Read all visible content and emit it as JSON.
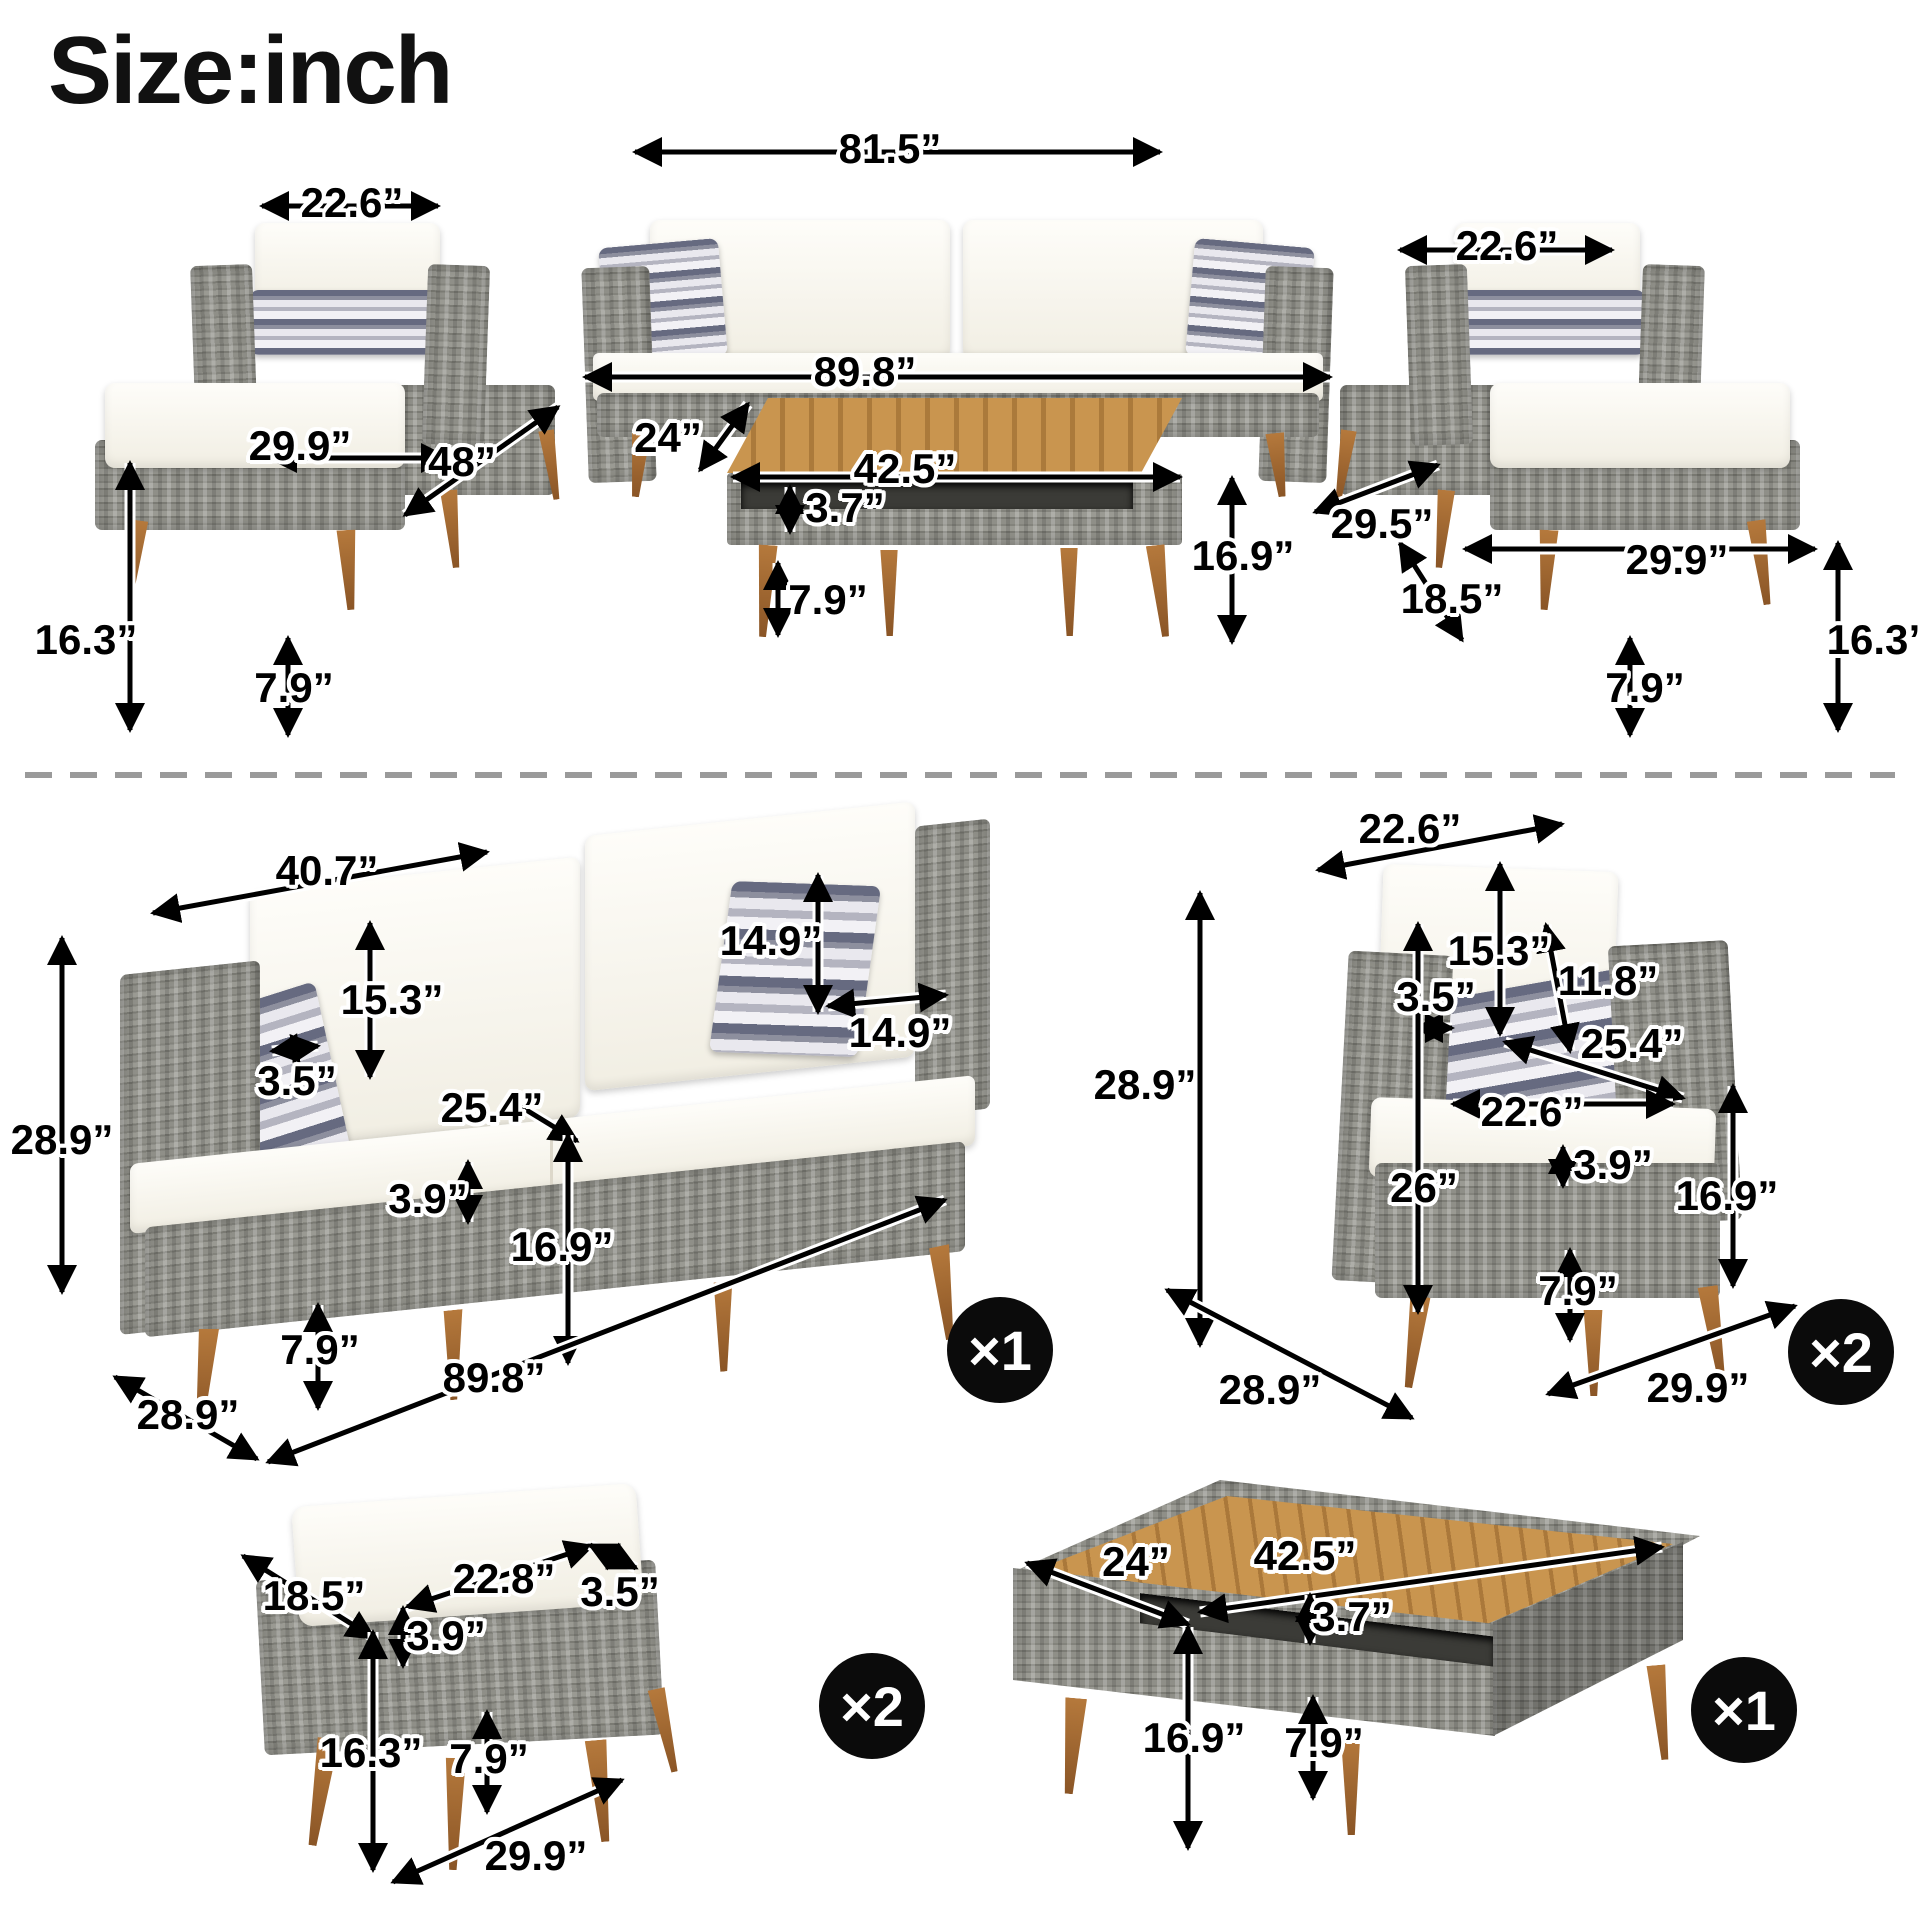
{
  "title": "Size:inch",
  "dimensions": [
    {
      "text": "22.6”",
      "x": 352,
      "y": 203
    },
    {
      "text": "81.5”",
      "x": 890,
      "y": 149
    },
    {
      "text": "22.6”",
      "x": 1507,
      "y": 246
    },
    {
      "text": "89.8”",
      "x": 865,
      "y": 372
    },
    {
      "text": "24”",
      "x": 668,
      "y": 438
    },
    {
      "text": "42.5”",
      "x": 905,
      "y": 469
    },
    {
      "text": "3.7”",
      "x": 845,
      "y": 508
    },
    {
      "text": "16.9”",
      "x": 1243,
      "y": 556
    },
    {
      "text": "7.9”",
      "x": 828,
      "y": 600
    },
    {
      "text": "29.9”",
      "x": 300,
      "y": 446
    },
    {
      "text": "48”",
      "x": 462,
      "y": 462
    },
    {
      "text": "16.3”",
      "x": 86,
      "y": 640
    },
    {
      "text": "7.9”",
      "x": 294,
      "y": 688
    },
    {
      "text": "29.5”",
      "x": 1382,
      "y": 524
    },
    {
      "text": "18.5”",
      "x": 1452,
      "y": 599
    },
    {
      "text": "29.9”",
      "x": 1677,
      "y": 560
    },
    {
      "text": "16.3”",
      "x": 1878,
      "y": 640
    },
    {
      "text": "7.9”",
      "x": 1645,
      "y": 688
    },
    {
      "text": "40.7”",
      "x": 327,
      "y": 871
    },
    {
      "text": "15.3”",
      "x": 392,
      "y": 1000
    },
    {
      "text": "3.5”",
      "x": 297,
      "y": 1081
    },
    {
      "text": "14.9”",
      "x": 771,
      "y": 941
    },
    {
      "text": "14.9”",
      "x": 900,
      "y": 1033
    },
    {
      "text": "25.4”",
      "x": 492,
      "y": 1108
    },
    {
      "text": "3.9”",
      "x": 428,
      "y": 1199
    },
    {
      "text": "16.9”",
      "x": 562,
      "y": 1247
    },
    {
      "text": "7.9”",
      "x": 320,
      "y": 1350
    },
    {
      "text": "28.9”",
      "x": 62,
      "y": 1140
    },
    {
      "text": "89.8”",
      "x": 494,
      "y": 1378
    },
    {
      "text": "28.9”",
      "x": 188,
      "y": 1415
    },
    {
      "text": "22.6”",
      "x": 1410,
      "y": 829
    },
    {
      "text": "15.3”",
      "x": 1499,
      "y": 951
    },
    {
      "text": "3.5”",
      "x": 1436,
      "y": 997
    },
    {
      "text": "11.8”",
      "x": 1608,
      "y": 981
    },
    {
      "text": "25.4”",
      "x": 1632,
      "y": 1044
    },
    {
      "text": "22.6”",
      "x": 1532,
      "y": 1112
    },
    {
      "text": "3.9”",
      "x": 1613,
      "y": 1165
    },
    {
      "text": "26”",
      "x": 1424,
      "y": 1188
    },
    {
      "text": "16.9”",
      "x": 1727,
      "y": 1196
    },
    {
      "text": "7.9”",
      "x": 1578,
      "y": 1291
    },
    {
      "text": "28.9”",
      "x": 1145,
      "y": 1085
    },
    {
      "text": "28.9”",
      "x": 1270,
      "y": 1390
    },
    {
      "text": "29.9”",
      "x": 1698,
      "y": 1388
    },
    {
      "text": "18.5”",
      "x": 314,
      "y": 1596
    },
    {
      "text": "22.8”",
      "x": 504,
      "y": 1579
    },
    {
      "text": "3.5”",
      "x": 620,
      "y": 1592
    },
    {
      "text": "3.9”",
      "x": 446,
      "y": 1636
    },
    {
      "text": "16.3”",
      "x": 371,
      "y": 1753
    },
    {
      "text": "7.9”",
      "x": 489,
      "y": 1759
    },
    {
      "text": "29.9”",
      "x": 536,
      "y": 1856
    },
    {
      "text": "24”",
      "x": 1136,
      "y": 1562
    },
    {
      "text": "42.5”",
      "x": 1305,
      "y": 1556
    },
    {
      "text": "3.7”",
      "x": 1352,
      "y": 1617
    },
    {
      "text": "16.9”",
      "x": 1194,
      "y": 1738
    },
    {
      "text": "7.9”",
      "x": 1324,
      "y": 1743
    }
  ],
  "quantity_badges": [
    {
      "label": "×1",
      "x": 1000,
      "y": 1350
    },
    {
      "label": "×2",
      "x": 1841,
      "y": 1352
    },
    {
      "label": "×2",
      "x": 872,
      "y": 1706
    },
    {
      "label": "×1",
      "x": 1744,
      "y": 1710
    }
  ],
  "colors": {
    "label_text": "#000000",
    "label_halo": "#ffffff",
    "badge_bg": "#0b0b0b",
    "badge_text": "#ffffff",
    "wicker_gray": "#8f8f88",
    "cushion_white": "#f7f4ec",
    "pillow_stripe_dark": "#666a80",
    "wood_leg": "#a8722f",
    "table_wood": "#c9954f",
    "divider_gray": "#9a9a9a"
  }
}
